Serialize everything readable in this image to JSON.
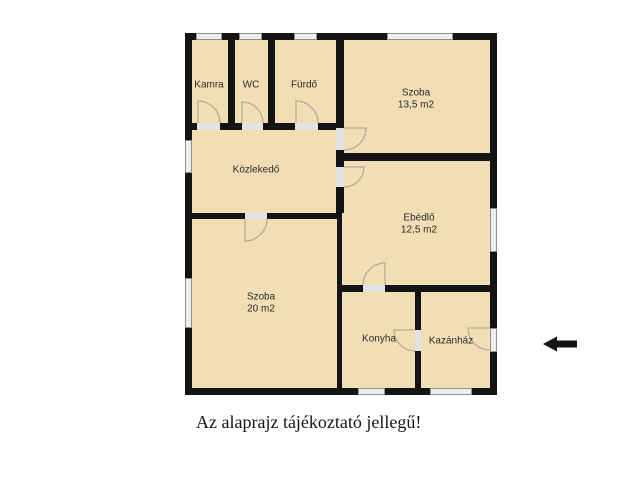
{
  "plan": {
    "rooms": {
      "kamra": {
        "name": "Kamra"
      },
      "wc": {
        "name": "WC"
      },
      "furdo": {
        "name": "Fürdő"
      },
      "szoba1": {
        "name": "Szoba",
        "area": "13,5 m2"
      },
      "kozlekedo": {
        "name": "Közlekedő"
      },
      "ebedlo": {
        "name": "Ebédlő",
        "area": "12,5 m2"
      },
      "szoba2": {
        "name": "Szoba",
        "area": "20 m2"
      },
      "konyha": {
        "name": "Konyha"
      },
      "kazanhaz": {
        "name": "Kazánház"
      }
    },
    "caption": "Az alaprajz tájékoztató jellegű!"
  },
  "colors": {
    "wall": "#141414",
    "floor": "#f2deb5",
    "window-fill": "#ededed",
    "window-border": "#8f8f8f",
    "door": "#b3ada0",
    "threshold": "#e2e2e2",
    "label": "#2b2b2b",
    "caption-color": "#141414",
    "arrow": "#141414",
    "background": "#ffffff"
  }
}
